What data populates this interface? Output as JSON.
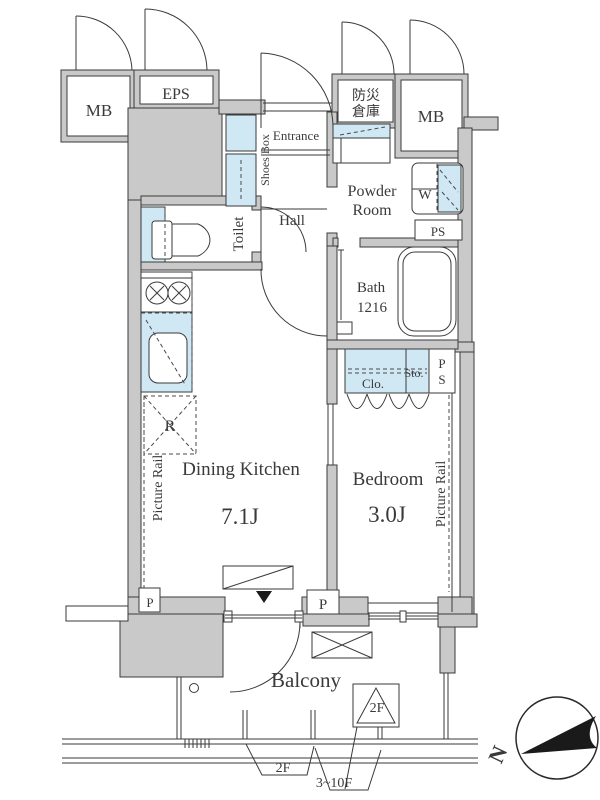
{
  "colors": {
    "wall_fill": "#c9c9c9",
    "fixture_fill": "#cfe8f4",
    "line": "#3a3a3a",
    "needle": "#1a1a1a"
  },
  "utility": {
    "mb_left": "MB",
    "eps": "EPS",
    "bousai_line1": "防災",
    "bousai_line2": "倉庫",
    "mb_right": "MB",
    "ps_top": "PS",
    "ps_side_line1": "P",
    "ps_side_line2": "S",
    "pipe_left": "P",
    "pipe_center": "P"
  },
  "rooms": {
    "entrance": "Entrance",
    "shoes_box": "Shoes Box",
    "hall": "Hall",
    "toilet": "Toilet",
    "powder_line1": "Powder",
    "powder_line2": "Room",
    "washer": "W",
    "bath_line1": "Bath",
    "bath_line2": "1216",
    "closet": "Clo.",
    "storage": "Sto.",
    "dining_kitchen": "Dining Kitchen",
    "dining_kitchen_size": "7.1J",
    "bedroom": "Bedroom",
    "bedroom_size": "3.0J",
    "refrigerator": "R",
    "picture_rail_left": "Picture Rail",
    "picture_rail_right": "Picture Rail",
    "balcony": "Balcony"
  },
  "annotations": {
    "floor_marker_box": "2F",
    "rail_2f": "2F",
    "rail_3_10f": "3~10F",
    "compass_north": "N"
  }
}
